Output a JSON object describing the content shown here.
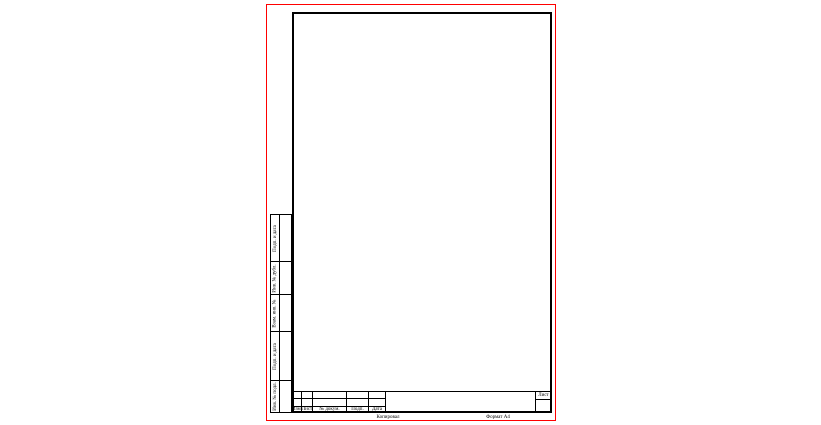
{
  "colors": {
    "sheet_border": "#ff0000",
    "line": "#000000",
    "paper": "#ffffff"
  },
  "left_margin": {
    "labels": [
      "Подп. и дата",
      "Инв. № дубл.",
      "Взам. инв. №",
      "Подп. и дата",
      "Инв. № подл."
    ]
  },
  "stamp": {
    "columns": [
      "Изм.",
      "Лист",
      "№ докум.",
      "Подп.",
      "Дата"
    ],
    "sheet_label": "Лист"
  },
  "footer": {
    "copied": "Копировал",
    "format": "Формат А4"
  }
}
